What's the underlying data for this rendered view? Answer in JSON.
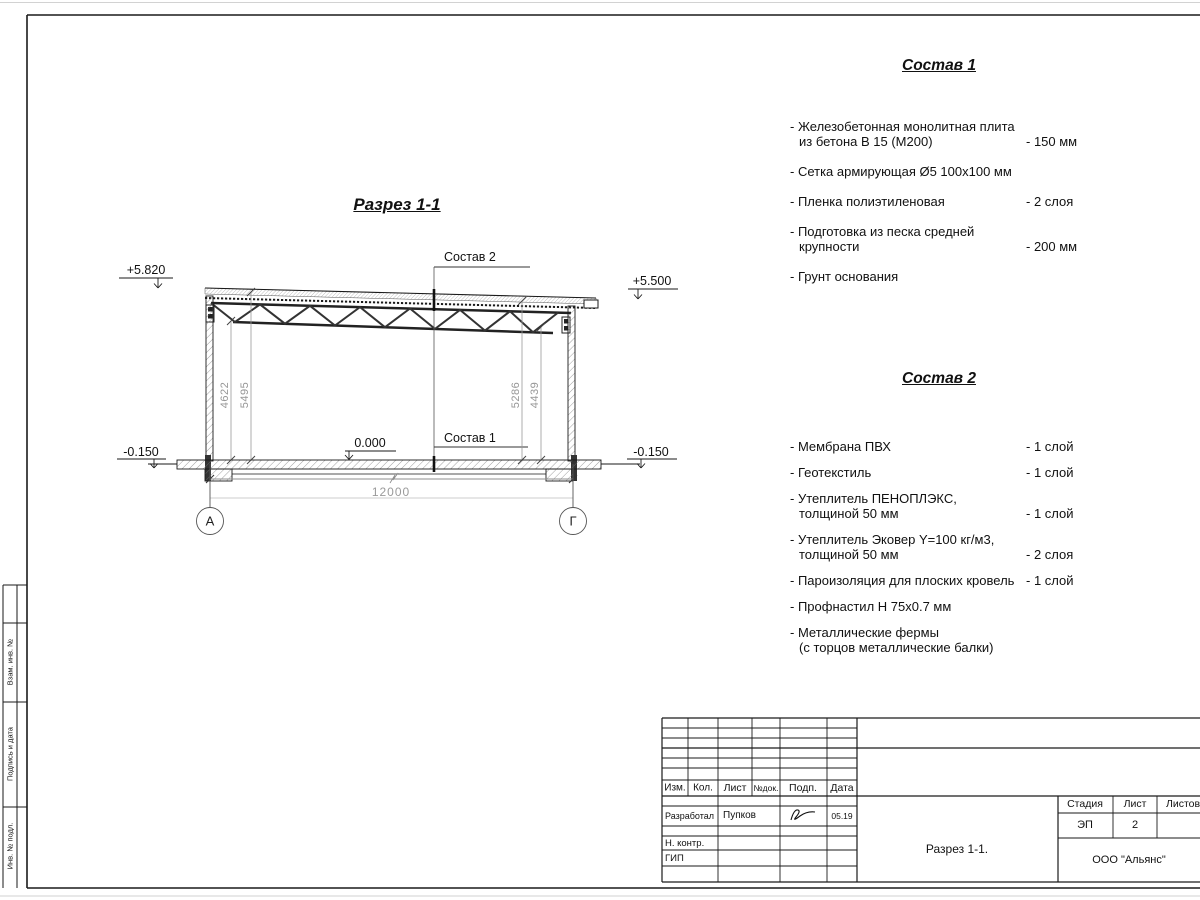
{
  "drawing": {
    "section_title": "Разрез 1-1",
    "levels": {
      "top_left": "+5.820",
      "top_right": "+5.500",
      "zero": "0.000",
      "bottom_left": "-0.150",
      "bottom_right": "-0.150"
    },
    "callouts": {
      "roof": "Состав 2",
      "floor": "Состав 1"
    },
    "dimensions": {
      "span": "12000",
      "left_inner": "4622",
      "left_outer": "5495",
      "right_inner": "5286",
      "right_outer": "4439"
    },
    "axes": {
      "left": "А",
      "right": "Г"
    }
  },
  "sostav1": {
    "title": "Состав 1",
    "items": [
      {
        "name": "- Железобетонная монолитная плита\nиз бетона В 15 (М200)",
        "value": "- 150 мм"
      },
      {
        "name": "- Сетка армирующая Ø5 100х100 мм",
        "value": ""
      },
      {
        "name": "- Пленка полиэтиленовая",
        "value": "-  2 слоя"
      },
      {
        "name": "- Подготовка из песка средней\nкрупности",
        "value": "- 200 мм"
      },
      {
        "name": "- Грунт основания",
        "value": ""
      }
    ]
  },
  "sostav2": {
    "title": "Состав 2",
    "items": [
      {
        "name": "- Мембрана ПВХ",
        "value": "- 1 слой"
      },
      {
        "name": "- Геотекстиль",
        "value": "- 1 слой"
      },
      {
        "name": "- Утеплитель ПЕНОПЛЭКС,\nтолщиной 50 мм",
        "value": "- 1 слой"
      },
      {
        "name": "- Утеплитель Эковер Y=100 кг/м3,\nтолщиной 50 мм",
        "value": "- 2 слоя"
      },
      {
        "name": "- Пароизоляция для плоских кровель",
        "value": "- 1 слой"
      },
      {
        "name": "- Профнастил Н 75х0.7 мм",
        "value": ""
      },
      {
        "name": "- Металлические фермы\n(с торцов металлические балки)",
        "value": ""
      }
    ]
  },
  "titleblock": {
    "headers": {
      "izm": "Изм.",
      "kol": "Кол.",
      "list": "Лист",
      "ndok": "№док.",
      "podp": "Подп.",
      "data": "Дата"
    },
    "rows": {
      "role1": "Разработал",
      "name1": "Пупков",
      "date1": "05.19",
      "role2": "Н. контр.",
      "role3": "ГИП"
    },
    "stage": {
      "label_stage": "Стадия",
      "label_sheet": "Лист",
      "label_sheets": "Листов",
      "stage_value": "ЭП",
      "sheet_value": "2",
      "sheets_value": ""
    },
    "doc_title": "Разрез 1-1.",
    "company": "ООО \"Альянс\""
  },
  "side_strip": {
    "labels": [
      "Взам. инв. №",
      "Подпись и дата",
      "Инв. № подл."
    ]
  }
}
